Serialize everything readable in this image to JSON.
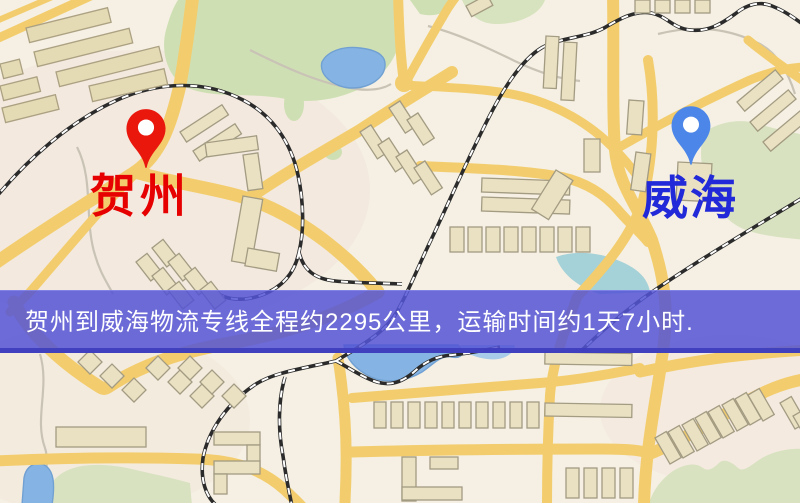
{
  "map": {
    "origin": {
      "name": "贺州",
      "pin_color": "#ea170d",
      "label_color": "#e60000"
    },
    "destination": {
      "name": "威海",
      "pin_color": "#4c86e8",
      "label_color": "#2229d8"
    },
    "palette": {
      "road": "#f3cd6d",
      "water": "#85b4e4",
      "park": "#cfdfb4",
      "building": "#eae1c3",
      "background": "#f5f0e3",
      "railway": "#2b2b2b"
    }
  },
  "banner": {
    "text": "贺州到威海物流专线全程约2295公里，运输时间约1天7小时.",
    "distance_km": "2295",
    "duration": "1天7小时",
    "background_rgba": "rgba(84,84,213,0.85)"
  }
}
